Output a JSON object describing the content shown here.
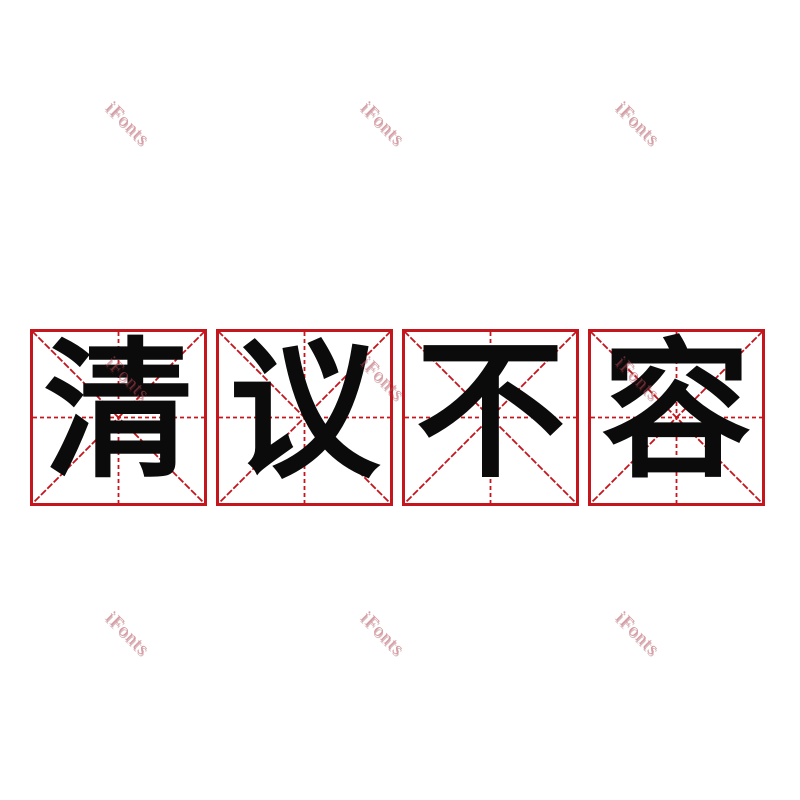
{
  "canvas": {
    "width": 800,
    "height": 800,
    "background_color": "#ffffff"
  },
  "phrase": {
    "text": "清议不容",
    "characters": [
      "清",
      "议",
      "不",
      "容"
    ],
    "style": "bold-rounded-cartoon",
    "color": "#0b0b0b"
  },
  "practice_grid": {
    "type": "mi-zi-ge",
    "cell_count": 4,
    "line_color": "#c5161d"
  },
  "watermark": {
    "text": "iFonts",
    "color": "#b74b58",
    "rotation_deg": 45,
    "count": 9
  }
}
